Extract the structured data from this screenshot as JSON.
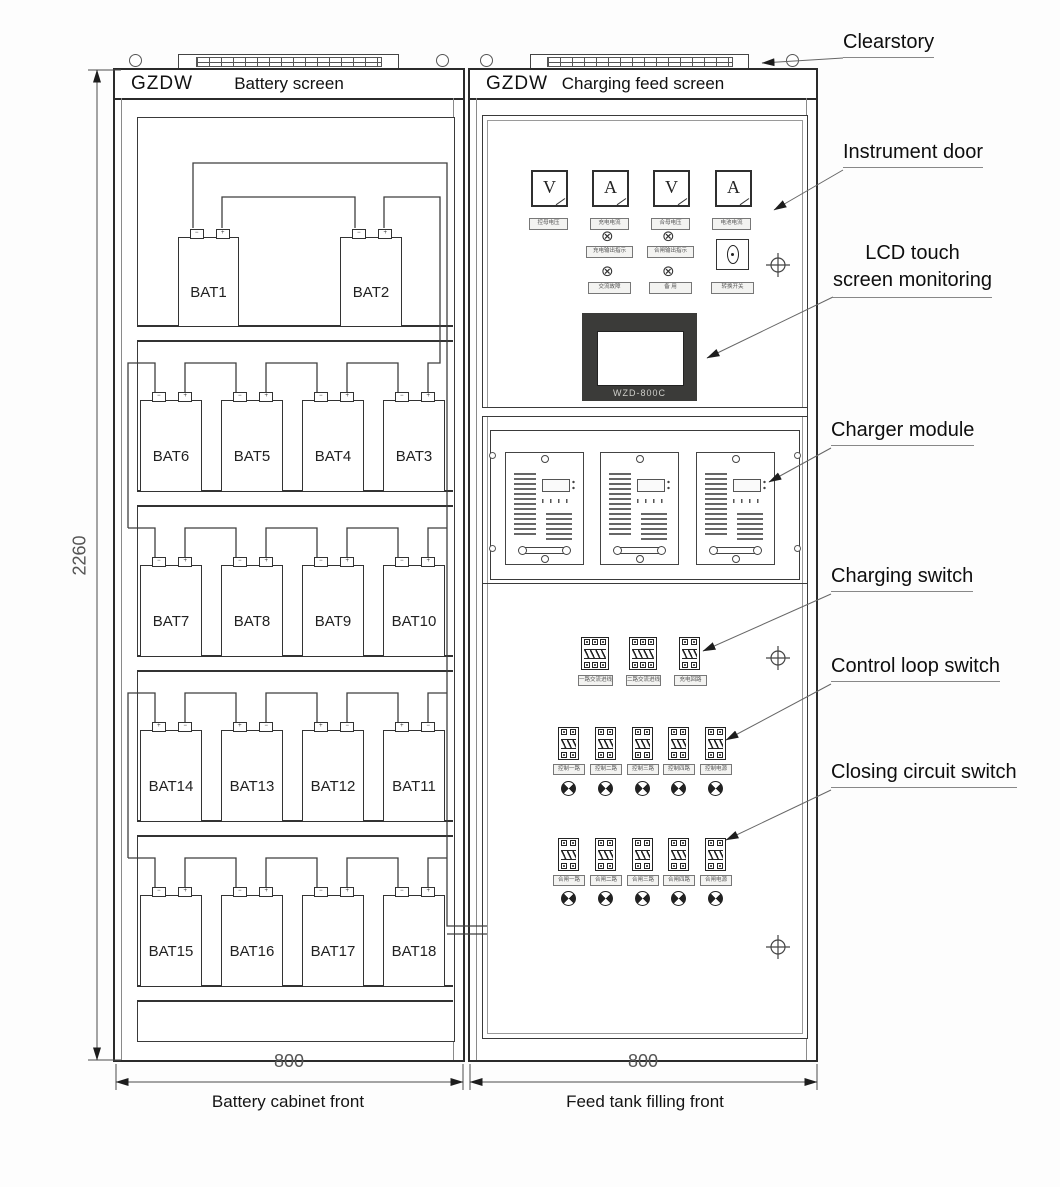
{
  "left_cabinet": {
    "brand": "GZDW",
    "title": "Battery screen",
    "terminal_neg": "−",
    "terminal_pos": "+",
    "rows": [
      [
        "BAT1",
        "BAT2"
      ],
      [
        "BAT6",
        "BAT5",
        "BAT4",
        "BAT3"
      ],
      [
        "BAT7",
        "BAT8",
        "BAT9",
        "BAT10"
      ],
      [
        "BAT14",
        "BAT13",
        "BAT12",
        "BAT11"
      ],
      [
        "BAT15",
        "BAT16",
        "BAT17",
        "BAT18"
      ]
    ]
  },
  "right_cabinet": {
    "brand": "GZDW",
    "title": "Charging feed screen",
    "meters": [
      {
        "symbol": "V",
        "label": "控母电压"
      },
      {
        "symbol": "A",
        "label": "充电电流"
      },
      {
        "symbol": "V",
        "label": "合母电压"
      },
      {
        "symbol": "A",
        "label": "电池电流"
      }
    ],
    "indicator_lights": [
      {
        "label": "充电输出指示"
      },
      {
        "label": "合闸输出指示"
      },
      {
        "label": "交流故障"
      },
      {
        "label": "备 用"
      }
    ],
    "rotary_switch_label": "转换开关",
    "lcd": {
      "model": "WZD-800C"
    },
    "charging_switches": [
      "一路交流进线",
      "二路交流进线",
      "充电回路"
    ],
    "control_switches": [
      "控制一路",
      "控制二路",
      "控制三路",
      "控制四路",
      "控制电源"
    ],
    "closing_switches": [
      "合闸一路",
      "合闸二路",
      "合闸三路",
      "合闸四路",
      "合闸电源"
    ]
  },
  "icons": {
    "indicator_light": "⊗"
  },
  "annotations": {
    "clearstory": "Clearstory",
    "instrument_door": "Instrument door",
    "lcd_line1": "LCD touch",
    "lcd_line2": "screen monitoring",
    "charger_module": "Charger module",
    "charging_switch": "Charging switch",
    "control_loop_switch": "Control loop switch",
    "closing_circuit_switch": "Closing circuit switch"
  },
  "dimensions": {
    "cabinet_height": "2260",
    "battery_cabinet_width": "800",
    "feed_cabinet_width": "800"
  },
  "captions": {
    "battery": "Battery cabinet front",
    "feed": "Feed tank filling front"
  }
}
